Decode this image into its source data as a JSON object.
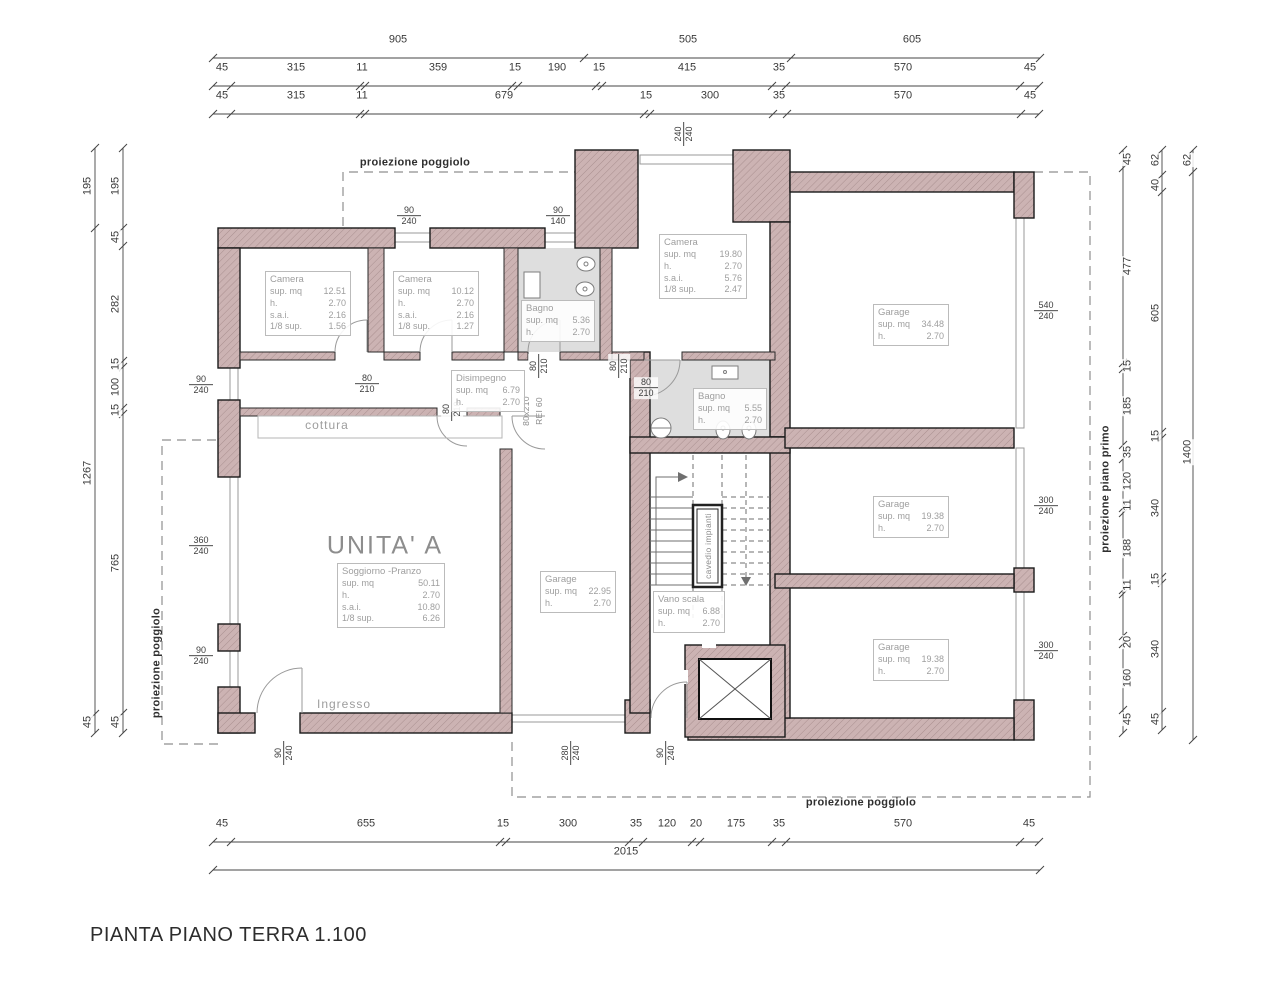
{
  "title": "PIANTA PIANO TERRA 1.100",
  "colors": {
    "wall": "#ccb3b3",
    "wall_hatch": "#a98f8f",
    "bath_floor": "#dedede",
    "dash": "#8f8f8f"
  },
  "rooms": [
    {
      "name": "Camera",
      "x": 265,
      "y": 271,
      "w": 76,
      "stats": [
        [
          "sup. mq",
          "12.51"
        ],
        [
          "h.",
          "2.70"
        ],
        [
          "s.a.i.",
          "2.16"
        ],
        [
          "1/8 sup.",
          "1.56"
        ]
      ]
    },
    {
      "name": "Camera",
      "x": 393,
      "y": 271,
      "w": 76,
      "stats": [
        [
          "sup. mq",
          "10.12"
        ],
        [
          "h.",
          "2.70"
        ],
        [
          "s.a.i.",
          "2.16"
        ],
        [
          "1/8 sup.",
          "1.27"
        ]
      ]
    },
    {
      "name": "Bagno",
      "x": 521,
      "y": 300,
      "w": 64,
      "stats": [
        [
          "sup. mq",
          "5.36"
        ],
        [
          "h.",
          "2.70"
        ]
      ]
    },
    {
      "name": "Camera",
      "x": 659,
      "y": 234,
      "w": 78,
      "stats": [
        [
          "sup. mq",
          "19.80"
        ],
        [
          "h.",
          "2.70"
        ],
        [
          "s.a.i.",
          "5.76"
        ],
        [
          "1/8 sup.",
          "2.47"
        ]
      ]
    },
    {
      "name": "Garage",
      "x": 873,
      "y": 304,
      "w": 66,
      "stats": [
        [
          "sup. mq",
          "34.48"
        ],
        [
          "h.",
          "2.70"
        ]
      ]
    },
    {
      "name": "Disimpegno",
      "x": 451,
      "y": 370,
      "w": 64,
      "stats": [
        [
          "sup. mq",
          "6.79"
        ],
        [
          "h.",
          "2.70"
        ]
      ]
    },
    {
      "name": "Bagno",
      "x": 693,
      "y": 388,
      "w": 64,
      "stats": [
        [
          "sup. mq",
          "5.55"
        ],
        [
          "h.",
          "2.70"
        ]
      ]
    },
    {
      "name": "Soggiorno -Pranzo",
      "x": 337,
      "y": 563,
      "w": 98,
      "stats": [
        [
          "sup. mq",
          "50.11"
        ],
        [
          "h.",
          "2.70"
        ],
        [
          "s.a.i.",
          "10.80"
        ],
        [
          "1/8 sup.",
          "6.26"
        ]
      ]
    },
    {
      "name": "Garage",
      "x": 540,
      "y": 571,
      "w": 66,
      "stats": [
        [
          "sup. mq",
          "22.95"
        ],
        [
          "h.",
          "2.70"
        ]
      ]
    },
    {
      "name": "Vano scala",
      "x": 653,
      "y": 591,
      "w": 62,
      "stats": [
        [
          "sup. mq",
          "6.88"
        ],
        [
          "h.",
          "2.70"
        ]
      ]
    },
    {
      "name": "Garage",
      "x": 873,
      "y": 496,
      "w": 66,
      "stats": [
        [
          "sup. mq",
          "19.38"
        ],
        [
          "h.",
          "2.70"
        ]
      ]
    },
    {
      "name": "Garage",
      "x": 873,
      "y": 639,
      "w": 66,
      "stats": [
        [
          "sup. mq",
          "19.38"
        ],
        [
          "h.",
          "2.70"
        ]
      ]
    }
  ],
  "annotations": [
    {
      "t": "proiezione poggiolo",
      "x": 415,
      "y": 163,
      "cls": "proj"
    },
    {
      "t": "proiezione poggiolo",
      "x": 157,
      "y": 663,
      "cls": "proj",
      "rot": -90
    },
    {
      "t": "proiezione poggiolo",
      "x": 861,
      "y": 803,
      "cls": "proj"
    },
    {
      "t": "proiezione piano primo",
      "x": 1106,
      "y": 489,
      "cls": "proj",
      "rot": -90
    },
    {
      "t": "cottura",
      "x": 327,
      "y": 425,
      "cls": "gray"
    },
    {
      "t": "Ingresso",
      "x": 344,
      "y": 704,
      "cls": "gray"
    },
    {
      "t": "cavedio impianti",
      "x": 708,
      "y": 546,
      "cls": "small",
      "rot": -90
    },
    {
      "t": "80x210",
      "x": 526,
      "y": 411,
      "cls": "small",
      "rot": -90
    },
    {
      "t": "REI 60",
      "x": 539,
      "y": 411,
      "cls": "small",
      "rot": -90
    },
    {
      "t": "UNITA' A",
      "x": 385,
      "y": 546,
      "cls": "big"
    }
  ],
  "dim_labels": [
    {
      "t": "905",
      "x": 398,
      "y": 40
    },
    {
      "t": "505",
      "x": 688,
      "y": 40
    },
    {
      "t": "605",
      "x": 912,
      "y": 40
    },
    {
      "t": "45",
      "x": 222,
      "y": 68
    },
    {
      "t": "315",
      "x": 296,
      "y": 68
    },
    {
      "t": "11",
      "x": 362,
      "y": 68
    },
    {
      "t": "359",
      "x": 438,
      "y": 68
    },
    {
      "t": "15",
      "x": 515,
      "y": 68
    },
    {
      "t": "190",
      "x": 557,
      "y": 68
    },
    {
      "t": "15",
      "x": 599,
      "y": 68
    },
    {
      "t": "415",
      "x": 687,
      "y": 68
    },
    {
      "t": "35",
      "x": 779,
      "y": 68
    },
    {
      "t": "570",
      "x": 903,
      "y": 68
    },
    {
      "t": "45",
      "x": 1030,
      "y": 68
    },
    {
      "t": "45",
      "x": 222,
      "y": 96
    },
    {
      "t": "315",
      "x": 296,
      "y": 96
    },
    {
      "t": "11",
      "x": 362,
      "y": 96
    },
    {
      "t": "679",
      "x": 504,
      "y": 96
    },
    {
      "t": "15",
      "x": 646,
      "y": 96
    },
    {
      "t": "300",
      "x": 710,
      "y": 96
    },
    {
      "t": "35",
      "x": 779,
      "y": 96
    },
    {
      "t": "570",
      "x": 903,
      "y": 96
    },
    {
      "t": "45",
      "x": 1030,
      "y": 96
    },
    {
      "t": "45",
      "x": 222,
      "y": 824
    },
    {
      "t": "655",
      "x": 366,
      "y": 824
    },
    {
      "t": "15",
      "x": 503,
      "y": 824
    },
    {
      "t": "300",
      "x": 568,
      "y": 824
    },
    {
      "t": "35",
      "x": 636,
      "y": 824
    },
    {
      "t": "120",
      "x": 667,
      "y": 824
    },
    {
      "t": "20",
      "x": 696,
      "y": 824
    },
    {
      "t": "175",
      "x": 736,
      "y": 824
    },
    {
      "t": "35",
      "x": 779,
      "y": 824
    },
    {
      "t": "570",
      "x": 903,
      "y": 824
    },
    {
      "t": "45",
      "x": 1029,
      "y": 824
    },
    {
      "t": "2015",
      "x": 626,
      "y": 852
    },
    {
      "t": "195",
      "x": 88,
      "y": 186,
      "rot": -90
    },
    {
      "t": "1267",
      "x": 88,
      "y": 473,
      "rot": -90
    },
    {
      "t": "45",
      "x": 88,
      "y": 722,
      "rot": -90
    },
    {
      "t": "195",
      "x": 116,
      "y": 186,
      "rot": -90
    },
    {
      "t": "45",
      "x": 116,
      "y": 237,
      "rot": -90
    },
    {
      "t": "282",
      "x": 116,
      "y": 304,
      "rot": -90
    },
    {
      "t": "15",
      "x": 116,
      "y": 364,
      "rot": -90
    },
    {
      "t": "100",
      "x": 116,
      "y": 387,
      "rot": -90
    },
    {
      "t": "15",
      "x": 116,
      "y": 410,
      "rot": -90
    },
    {
      "t": "765",
      "x": 116,
      "y": 563,
      "rot": -90
    },
    {
      "t": "45",
      "x": 116,
      "y": 722,
      "rot": -90
    },
    {
      "t": "45",
      "x": 1128,
      "y": 159,
      "rot": -90
    },
    {
      "t": "477",
      "x": 1128,
      "y": 266,
      "rot": -90
    },
    {
      "t": "15",
      "x": 1128,
      "y": 366,
      "rot": -90
    },
    {
      "t": "185",
      "x": 1128,
      "y": 406,
      "rot": -90
    },
    {
      "t": "35",
      "x": 1128,
      "y": 452,
      "rot": -90
    },
    {
      "t": "120",
      "x": 1128,
      "y": 481,
      "rot": -90
    },
    {
      "t": "11",
      "x": 1128,
      "y": 505,
      "rot": -90
    },
    {
      "t": "188",
      "x": 1128,
      "y": 548,
      "rot": -90
    },
    {
      "t": "11",
      "x": 1128,
      "y": 585,
      "rot": -90
    },
    {
      "t": "20",
      "x": 1128,
      "y": 642,
      "rot": -90
    },
    {
      "t": "160",
      "x": 1128,
      "y": 678,
      "rot": -90
    },
    {
      "t": "45",
      "x": 1128,
      "y": 719,
      "rot": -90
    },
    {
      "t": "62",
      "x": 1156,
      "y": 160,
      "rot": -90
    },
    {
      "t": "40",
      "x": 1156,
      "y": 185,
      "rot": -90
    },
    {
      "t": "605",
      "x": 1156,
      "y": 313,
      "rot": -90
    },
    {
      "t": "15",
      "x": 1156,
      "y": 436,
      "rot": -90
    },
    {
      "t": "340",
      "x": 1156,
      "y": 508,
      "rot": -90
    },
    {
      "t": "15",
      "x": 1156,
      "y": 579,
      "rot": -90
    },
    {
      "t": "340",
      "x": 1156,
      "y": 649,
      "rot": -90
    },
    {
      "t": "45",
      "x": 1156,
      "y": 719,
      "rot": -90
    },
    {
      "t": "62",
      "x": 1188,
      "y": 160,
      "rot": -90
    },
    {
      "t": "1400",
      "x": 1188,
      "y": 452,
      "rot": -90
    }
  ],
  "fractions": [
    {
      "a": "90",
      "b": "240",
      "x": 409,
      "y": 216
    },
    {
      "a": "90",
      "b": "140",
      "x": 558,
      "y": 216
    },
    {
      "a": "240",
      "b": "240",
      "x": 684,
      "y": 134,
      "rot": -90
    },
    {
      "a": "90",
      "b": "240",
      "x": 201,
      "y": 385
    },
    {
      "a": "360",
      "b": "240",
      "x": 201,
      "y": 546
    },
    {
      "a": "90",
      "b": "240",
      "x": 201,
      "y": 656
    },
    {
      "a": "540",
      "b": "240",
      "x": 1046,
      "y": 311
    },
    {
      "a": "300",
      "b": "240",
      "x": 1046,
      "y": 506
    },
    {
      "a": "300",
      "b": "240",
      "x": 1046,
      "y": 651
    },
    {
      "a": "80",
      "b": "210",
      "x": 367,
      "y": 384
    },
    {
      "a": "80",
      "b": "210",
      "x": 452,
      "y": 409,
      "rot": -90
    },
    {
      "a": "80",
      "b": "210",
      "x": 539,
      "y": 366,
      "rot": -90
    },
    {
      "a": "80",
      "b": "210",
      "x": 619,
      "y": 366,
      "rot": -90
    },
    {
      "a": "80",
      "b": "210",
      "x": 646,
      "y": 388
    },
    {
      "a": "90",
      "b": "240",
      "x": 284,
      "y": 753,
      "rot": -90
    },
    {
      "a": "280",
      "b": "240",
      "x": 571,
      "y": 753,
      "rot": -90
    },
    {
      "a": "90",
      "b": "240",
      "x": 666,
      "y": 753,
      "rot": -90
    }
  ]
}
